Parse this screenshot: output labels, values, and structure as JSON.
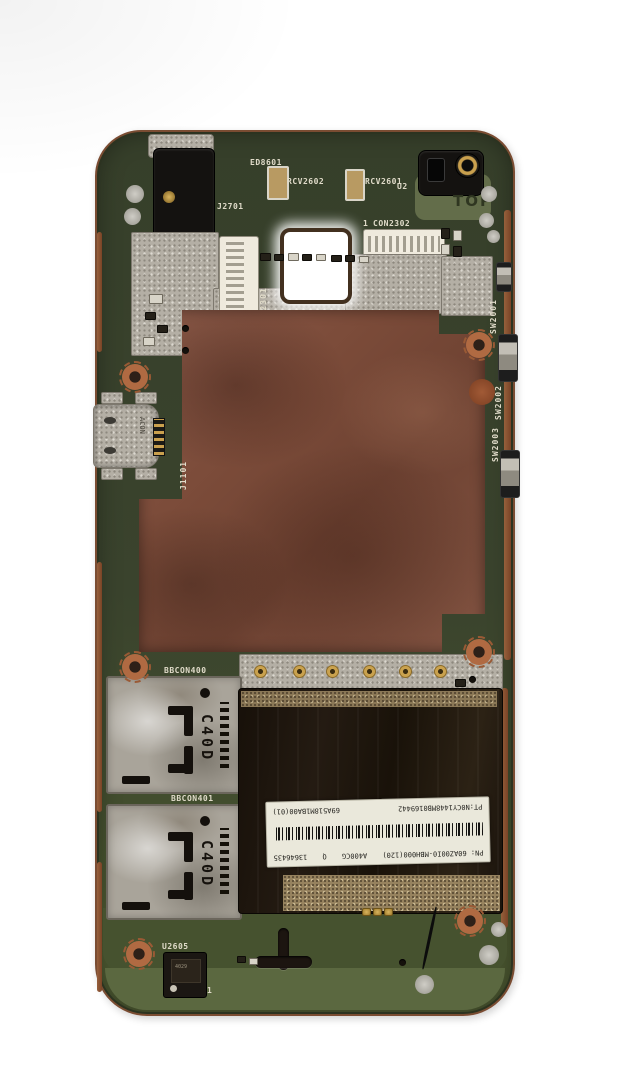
{
  "photo": {
    "subject": "smartphone mainboard, component side, on white background"
  },
  "silkscreen": {
    "top_marking": "TOP",
    "ed8601": "ED8601",
    "rcv2602": "RCV2602",
    "rcv2601": "RCV2601",
    "u2_partial": "U2",
    "j2701": "J2701",
    "con2302_pin1": "1",
    "con2302": "CON2302",
    "con2301": "CON2301",
    "sw2001": "SW2001",
    "sw2002": "SW2002",
    "sw2003": "SW2003",
    "j1101": "J1101",
    "bbcon400": "BBCON400",
    "bbcon401": "BBCON401",
    "u2605": "U2605",
    "u2605_pin1": "1"
  },
  "components": {
    "usb_marking": "ACON",
    "sim_shield_cutout": "C40D",
    "u2605_chip_marking": "4029"
  },
  "sticker": {
    "pn_line": "PN: 60AZ00I0-MBH000(120)",
    "model": "A400CG",
    "qc_mark": "Q",
    "serial": "13646435",
    "pt_line": "PT:N0CY1448MB0169442",
    "code": "69A518M1BA00(01)"
  },
  "colors": {
    "pcb_green": "#3a432d",
    "pcb_green_light": "#5b6840",
    "copper_shield": "#7b4b39",
    "copper_edge": "#8a5a3a",
    "shield_silver": "#b4afa5",
    "component_black": "#17120d",
    "silkscreen_white": "#e0dbc9",
    "gold": "#caa24e",
    "sticker_white": "#eae8db",
    "background": "#ffffff"
  }
}
